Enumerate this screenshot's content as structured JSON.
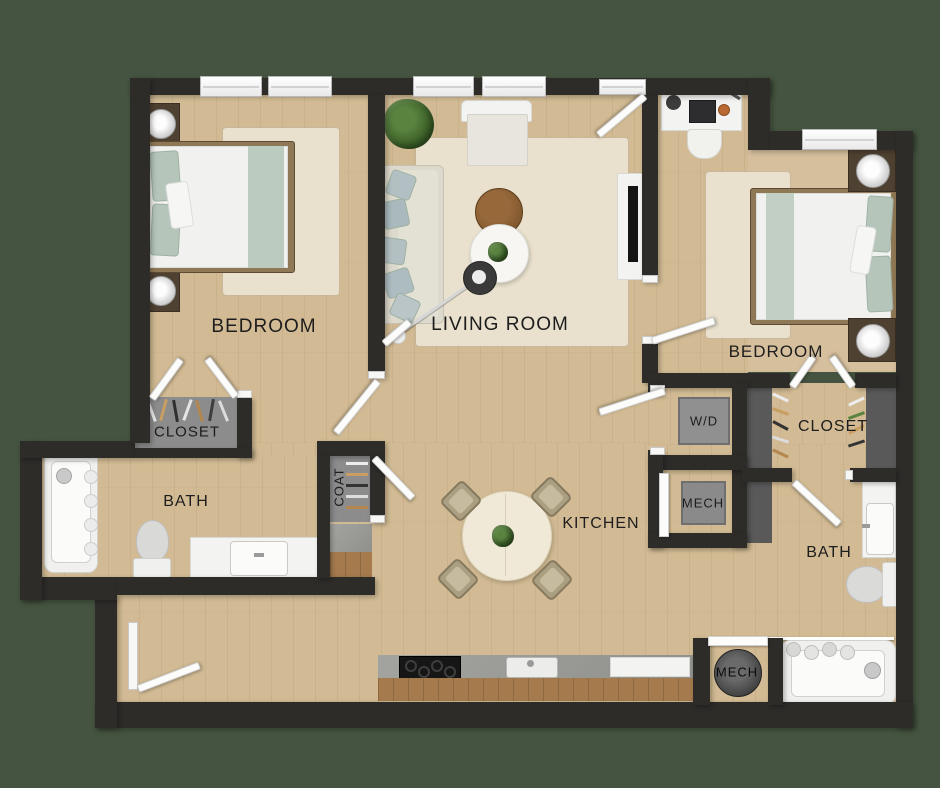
{
  "plan_title": "Two bedroom two bath apartment floor plan",
  "labels": {
    "bedroom_left": "BEDROOM",
    "living_room": "LIVING ROOM",
    "bedroom_right": "BEDROOM",
    "closet_left": "CLOSET",
    "coat": "COAT",
    "bath_left": "BATH",
    "kitchen": "KITCHEN",
    "wd": "W/D",
    "mech_upper": "MECH",
    "closet_right": "CLOSET",
    "bath_right": "BATH",
    "mech_lower": "MECH"
  },
  "colors": {
    "bg": "#455440",
    "wall": "#2e2c29",
    "floor": "#d2bb94",
    "floor2": "#d6bf9d",
    "rug": "#e9e1cd",
    "sage": "#bccbc0",
    "woodtrim": "#a57b4e",
    "granite": "#9c9c98",
    "closetfloor": "#8c8c8c",
    "label": "#1d1d1d"
  }
}
